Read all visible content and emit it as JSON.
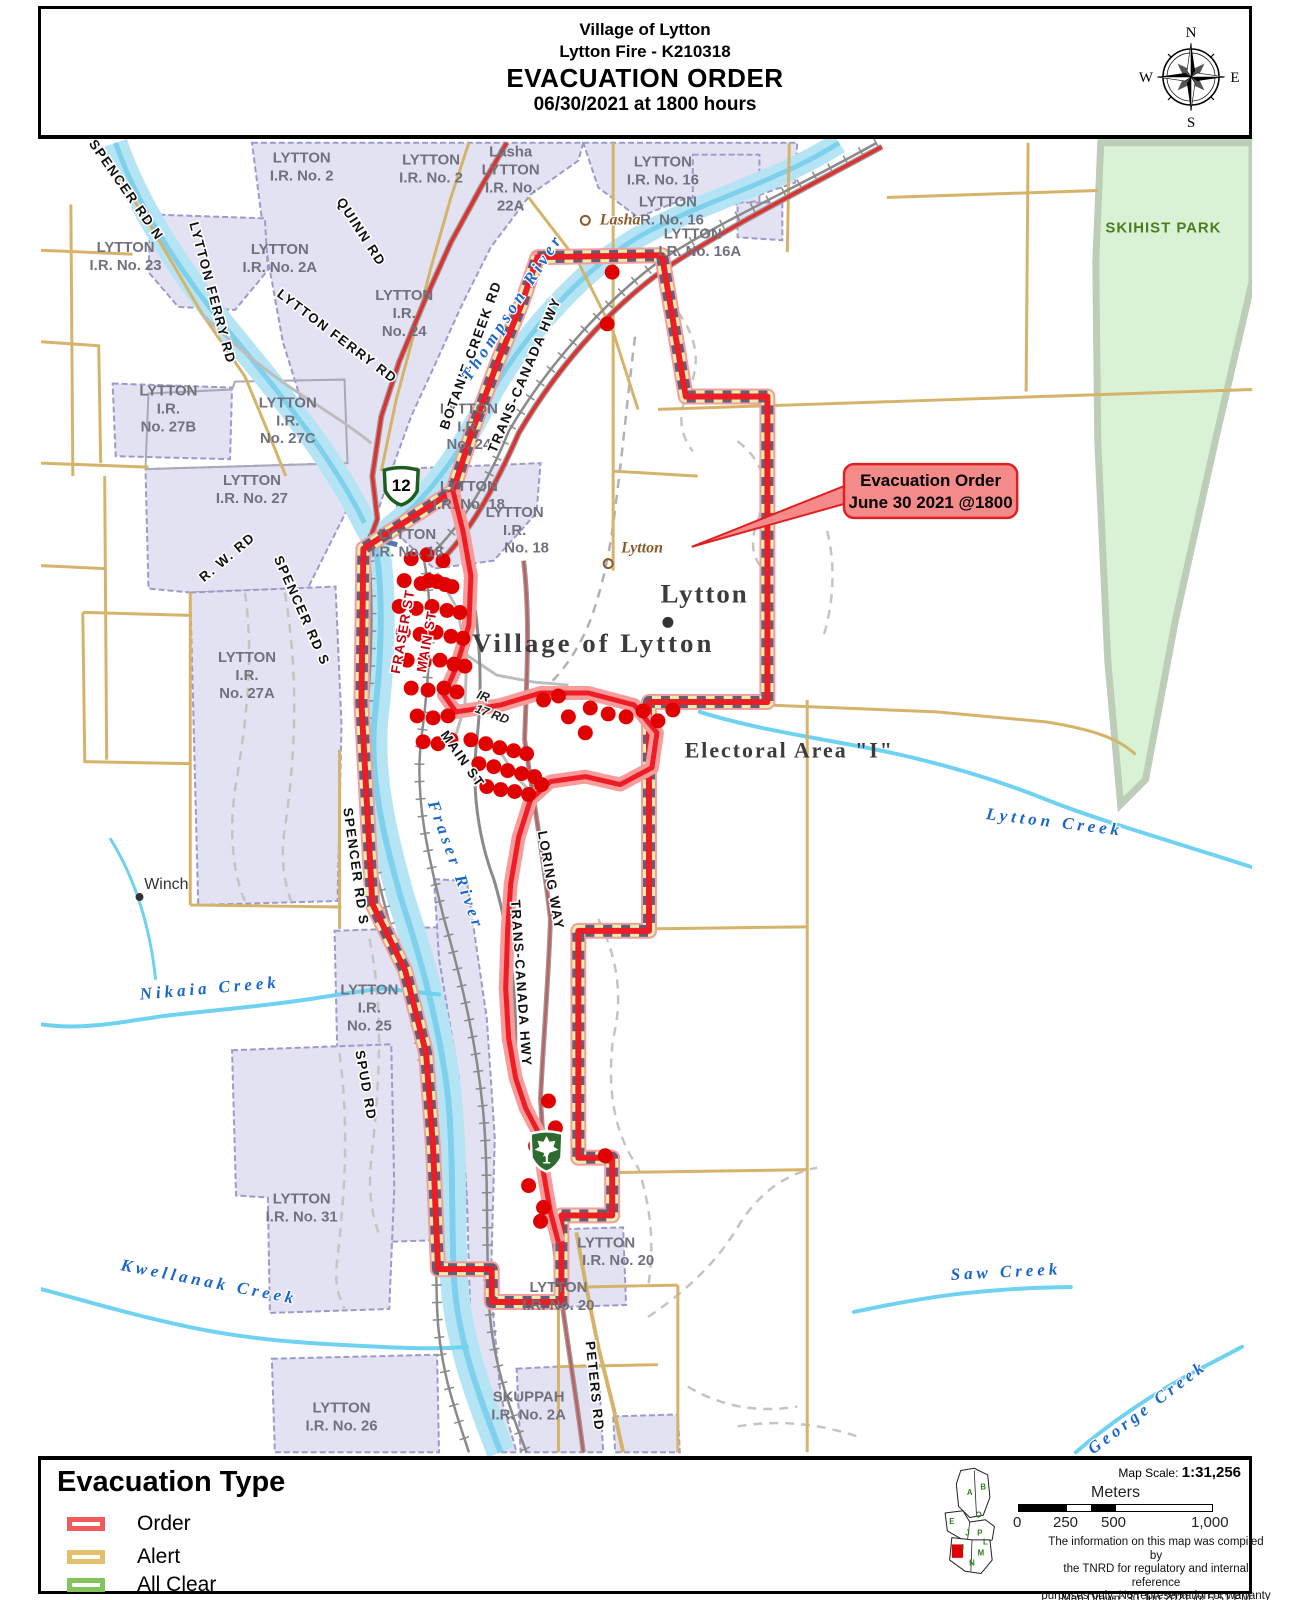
{
  "title": {
    "line1": "Village of Lytton",
    "line2": "Lytton Fire - K210318",
    "line3": "EVACUATION ORDER",
    "line4": "06/30/2021 at 1800 hours"
  },
  "compass": {
    "n": "N",
    "e": "E",
    "s": "S",
    "w": "W"
  },
  "callout": {
    "line1": "Evacuation Order",
    "line2": "June 30 2021 @1800"
  },
  "legend": {
    "title": "Evacuation Type",
    "items": [
      {
        "label": "Order",
        "color": "#ef5a5a"
      },
      {
        "label": "Alert",
        "color": "#e5c06c"
      },
      {
        "label": "All Clear",
        "color": "#84c45c"
      }
    ]
  },
  "scale": {
    "label": "Map Scale:",
    "value": "1:31,256",
    "units": "Meters",
    "ticks": [
      "0",
      "250",
      "500",
      "1,000"
    ]
  },
  "credits": {
    "line1": "The information on this map was compiled by",
    "line2": "the TNRD for regulatory and internal reference",
    "line3": "purposes only.  No representation or warranty",
    "line4": "is made as to the accuracy of the information.",
    "drawn": "Map Drawn: 30 Jun 2021 @ 5:51 PM"
  },
  "map": {
    "colors": {
      "order_red": "#ee1c25",
      "order_halo": "#f79b9b",
      "muni_dash": "#5f5f78",
      "parcel_fill": "#e2e2f2",
      "parcel_edge": "#9b9bcb",
      "river": "#b5e5f4",
      "river_accent": "#7fd0ec",
      "road_tan": "#d6b36b",
      "hwy_red": "#e03030",
      "park_green": "#d9f2d5",
      "dot_red": "#e10000",
      "water_label": "#1b66cc"
    },
    "shields": [
      {
        "route": "12"
      },
      {
        "route": "1"
      }
    ],
    "labels": [
      {
        "t": "LYTTON",
        "x": 262,
        "y": 20,
        "c": "p"
      },
      {
        "t": "I.R. No. 2",
        "x": 262,
        "y": 38,
        "c": "p"
      },
      {
        "t": "LYTTON",
        "x": 392,
        "y": 22,
        "c": "p"
      },
      {
        "t": "I.R. No. 2",
        "x": 392,
        "y": 40,
        "c": "p"
      },
      {
        "t": "Lasha",
        "x": 472,
        "y": 14,
        "c": "p"
      },
      {
        "t": "LYTTON",
        "x": 472,
        "y": 32,
        "c": "p"
      },
      {
        "t": "I.R. No.",
        "x": 472,
        "y": 50,
        "c": "p"
      },
      {
        "t": "22A",
        "x": 472,
        "y": 68,
        "c": "p"
      },
      {
        "t": "LYTTON",
        "x": 625,
        "y": 24,
        "c": "p"
      },
      {
        "t": "I.R. No. 16",
        "x": 625,
        "y": 42,
        "c": "p"
      },
      {
        "t": "LYTTON",
        "x": 630,
        "y": 64,
        "c": "p"
      },
      {
        "t": "I.R. No. 16",
        "x": 630,
        "y": 82,
        "c": "p"
      },
      {
        "t": "LYTTON",
        "x": 655,
        "y": 96,
        "c": "p"
      },
      {
        "t": "I.R. No. 16A",
        "x": 662,
        "y": 114,
        "c": "p"
      },
      {
        "t": "LYTTON",
        "x": 85,
        "y": 110,
        "c": "p"
      },
      {
        "t": "I.R. No. 23",
        "x": 85,
        "y": 128,
        "c": "p"
      },
      {
        "t": "LYTTON",
        "x": 240,
        "y": 112,
        "c": "p"
      },
      {
        "t": "I.R. No. 2A",
        "x": 240,
        "y": 130,
        "c": "p"
      },
      {
        "t": "LYTTON",
        "x": 365,
        "y": 158,
        "c": "p"
      },
      {
        "t": "I.R.",
        "x": 365,
        "y": 176,
        "c": "p"
      },
      {
        "t": "No. 24",
        "x": 365,
        "y": 194,
        "c": "p"
      },
      {
        "t": "LYTTON",
        "x": 128,
        "y": 254,
        "c": "p"
      },
      {
        "t": "I.R.",
        "x": 128,
        "y": 272,
        "c": "p"
      },
      {
        "t": "No. 27B",
        "x": 128,
        "y": 290,
        "c": "p"
      },
      {
        "t": "LYTTON",
        "x": 248,
        "y": 266,
        "c": "p"
      },
      {
        "t": "I.R.",
        "x": 248,
        "y": 284,
        "c": "p"
      },
      {
        "t": "No. 27C",
        "x": 248,
        "y": 302,
        "c": "p"
      },
      {
        "t": "LYTTON",
        "x": 212,
        "y": 344,
        "c": "p"
      },
      {
        "t": "I.R. No. 27",
        "x": 212,
        "y": 362,
        "c": "p"
      },
      {
        "t": "LYTTON",
        "x": 430,
        "y": 272,
        "c": "p"
      },
      {
        "t": "I.R.",
        "x": 430,
        "y": 290,
        "c": "p"
      },
      {
        "t": "No. 24",
        "x": 430,
        "y": 308,
        "c": "p"
      },
      {
        "t": "LYTTON",
        "x": 430,
        "y": 350,
        "c": "p"
      },
      {
        "t": "I.R. No. 18",
        "x": 430,
        "y": 368,
        "c": "p"
      },
      {
        "t": "LYTTON",
        "x": 368,
        "y": 398,
        "c": "p"
      },
      {
        "t": "I.R. No. 18",
        "x": 368,
        "y": 416,
        "c": "p"
      },
      {
        "t": "LYTTON",
        "x": 476,
        "y": 376,
        "c": "p"
      },
      {
        "t": "I.R.",
        "x": 476,
        "y": 394,
        "c": "p"
      },
      {
        "t": "No. 18",
        "x": 488,
        "y": 412,
        "c": "p"
      },
      {
        "t": "LYTTON",
        "x": 207,
        "y": 522,
        "c": "p"
      },
      {
        "t": "I.R.",
        "x": 207,
        "y": 540,
        "c": "p"
      },
      {
        "t": "No. 27A",
        "x": 207,
        "y": 558,
        "c": "p"
      },
      {
        "t": "LYTTON",
        "x": 330,
        "y": 856,
        "c": "p"
      },
      {
        "t": "I.R.",
        "x": 330,
        "y": 874,
        "c": "p"
      },
      {
        "t": "No. 25",
        "x": 330,
        "y": 892,
        "c": "p"
      },
      {
        "t": "LYTTON",
        "x": 262,
        "y": 1066,
        "c": "p"
      },
      {
        "t": "I.R. No. 31",
        "x": 262,
        "y": 1084,
        "c": "p"
      },
      {
        "t": "LYTTON",
        "x": 568,
        "y": 1110,
        "c": "p"
      },
      {
        "t": "I.R. No. 20",
        "x": 580,
        "y": 1128,
        "c": "p"
      },
      {
        "t": "LYTTON",
        "x": 520,
        "y": 1155,
        "c": "p"
      },
      {
        "t": "I.R. No. 20",
        "x": 520,
        "y": 1173,
        "c": "p"
      },
      {
        "t": "LYTTON",
        "x": 302,
        "y": 1276,
        "c": "p"
      },
      {
        "t": "I.R. No. 26",
        "x": 302,
        "y": 1294,
        "c": "p"
      },
      {
        "t": "SKUPPAH",
        "x": 490,
        "y": 1265,
        "c": "p"
      },
      {
        "t": "I.R. No. 2A",
        "x": 490,
        "y": 1283,
        "c": "p"
      },
      {
        "t": "SPENCER RD N",
        "x": 82,
        "y": 50,
        "r": 55,
        "c": "r"
      },
      {
        "t": "QUINN RD",
        "x": 318,
        "y": 92,
        "r": 57,
        "c": "r"
      },
      {
        "t": "LYTTON FERRY RD",
        "x": 168,
        "y": 152,
        "r": 75,
        "c": "r"
      },
      {
        "t": "LYTTON FERRY RD",
        "x": 295,
        "y": 198,
        "r": 37,
        "c": "r"
      },
      {
        "t": "BOTANIE CREEK RD",
        "x": 436,
        "y": 215,
        "r": -70,
        "c": "r"
      },
      {
        "t": "TRANS-CANADA HWY",
        "x": 490,
        "y": 235,
        "r": -67,
        "c": "r"
      },
      {
        "t": "TRANS-CANADA HWY",
        "x": 478,
        "y": 845,
        "r": 86,
        "c": "r"
      },
      {
        "t": "R. W. RD",
        "x": 190,
        "y": 420,
        "r": -40,
        "c": "r"
      },
      {
        "t": "SPENCER RD S",
        "x": 258,
        "y": 472,
        "r": 66,
        "c": "r"
      },
      {
        "t": "SPENCER RD S",
        "x": 312,
        "y": 728,
        "r": 82,
        "c": "r"
      },
      {
        "t": "MAIN ST",
        "x": 420,
        "y": 622,
        "r": 55,
        "c": "r"
      },
      {
        "t": "LORING WAY",
        "x": 508,
        "y": 742,
        "r": 80,
        "c": "r"
      },
      {
        "t": "SPUD RD",
        "x": 322,
        "y": 948,
        "r": 80,
        "c": "r"
      },
      {
        "t": "PETERS RD",
        "x": 552,
        "y": 1250,
        "r": 84,
        "c": "r"
      },
      {
        "t": "FRASER ST",
        "x": 368,
        "y": 492,
        "r": -80,
        "c": "rr"
      },
      {
        "t": "MAIN ST",
        "x": 392,
        "y": 502,
        "r": -80,
        "c": "rr"
      },
      {
        "t": "IR",
        "x": 443,
        "y": 560,
        "r": 20,
        "c": "ri"
      },
      {
        "t": "17 RD",
        "x": 452,
        "y": 578,
        "r": 20,
        "c": "ri"
      },
      {
        "t": "Thompson River",
        "x": 478,
        "y": 168,
        "r": -57,
        "c": "w"
      },
      {
        "t": "Fraser River",
        "x": 412,
        "y": 728,
        "r": 70,
        "c": "w"
      },
      {
        "t": "Nikaia Creek",
        "x": 170,
        "y": 855,
        "r": -5,
        "c": "w"
      },
      {
        "t": "Kwellanak Creek",
        "x": 168,
        "y": 1150,
        "r": 11,
        "c": "w"
      },
      {
        "t": "Lytton Creek",
        "x": 1018,
        "y": 688,
        "r": 7,
        "c": "w"
      },
      {
        "t": "Saw Creek",
        "x": 970,
        "y": 1140,
        "r": -3,
        "c": "w"
      },
      {
        "t": "George Creek",
        "x": 1115,
        "y": 1275,
        "r": -37,
        "c": "w"
      },
      {
        "t": "Lasha",
        "x": 582,
        "y": 82,
        "c": "pi"
      },
      {
        "t": "Lytton",
        "x": 604,
        "y": 412,
        "c": "pi"
      },
      {
        "t": "Lytton",
        "x": 667,
        "y": 462,
        "c": "pl"
      },
      {
        "t": "Village of Lytton",
        "x": 555,
        "y": 512,
        "c": "vs"
      },
      {
        "t": "Electoral Area \"I\"",
        "x": 752,
        "y": 618,
        "c": "ea"
      },
      {
        "t": "Winch",
        "x": 126,
        "y": 750,
        "c": "wn"
      },
      {
        "t": "SKIHIST PARK",
        "x": 1128,
        "y": 90,
        "c": "pk"
      }
    ],
    "dots": [
      [
        372,
        418
      ],
      [
        388,
        414
      ],
      [
        404,
        420
      ],
      [
        365,
        440
      ],
      [
        382,
        443
      ],
      [
        398,
        441
      ],
      [
        413,
        446
      ],
      [
        360,
        466
      ],
      [
        377,
        468
      ],
      [
        393,
        466
      ],
      [
        408,
        470
      ],
      [
        421,
        472
      ],
      [
        364,
        492
      ],
      [
        381,
        494
      ],
      [
        397,
        492
      ],
      [
        412,
        496
      ],
      [
        424,
        498
      ],
      [
        368,
        520
      ],
      [
        385,
        522
      ],
      [
        401,
        520
      ],
      [
        415,
        524
      ],
      [
        426,
        526
      ],
      [
        372,
        548
      ],
      [
        389,
        550
      ],
      [
        405,
        548
      ],
      [
        418,
        552
      ],
      [
        378,
        576
      ],
      [
        394,
        578
      ],
      [
        409,
        576
      ],
      [
        384,
        602
      ],
      [
        399,
        604
      ],
      [
        412,
        600
      ],
      [
        390,
        440
      ],
      [
        406,
        444
      ],
      [
        432,
        600
      ],
      [
        447,
        604
      ],
      [
        461,
        608
      ],
      [
        475,
        611
      ],
      [
        488,
        614
      ],
      [
        440,
        624
      ],
      [
        455,
        627
      ],
      [
        469,
        631
      ],
      [
        483,
        634
      ],
      [
        496,
        637
      ],
      [
        448,
        647
      ],
      [
        462,
        650
      ],
      [
        476,
        652
      ],
      [
        490,
        655
      ],
      [
        503,
        645
      ],
      [
        552,
        568
      ],
      [
        570,
        574
      ],
      [
        588,
        577
      ],
      [
        605,
        571
      ],
      [
        620,
        581
      ],
      [
        635,
        570
      ],
      [
        530,
        577
      ],
      [
        547,
        593
      ],
      [
        505,
        560
      ],
      [
        520,
        556
      ],
      [
        574,
        130
      ],
      [
        569,
        182
      ],
      [
        510,
        963
      ],
      [
        497,
        1008
      ],
      [
        490,
        1048
      ],
      [
        505,
        1070
      ],
      [
        502,
        1084
      ],
      [
        567,
        1018
      ],
      [
        517,
        990
      ]
    ],
    "inset_letters": [
      {
        "t": "A",
        "x": 26,
        "y": 26
      },
      {
        "t": "B",
        "x": 38,
        "y": 21
      },
      {
        "t": "E",
        "x": 10,
        "y": 52
      },
      {
        "t": "O",
        "x": 34,
        "y": 46
      },
      {
        "t": "J",
        "x": 24,
        "y": 62
      },
      {
        "t": "P",
        "x": 35,
        "y": 62
      },
      {
        "t": "L",
        "x": 40,
        "y": 70
      },
      {
        "t": "I",
        "x": 20,
        "y": 75
      },
      {
        "t": "M",
        "x": 36,
        "y": 80
      },
      {
        "t": "N",
        "x": 28,
        "y": 89
      }
    ]
  }
}
